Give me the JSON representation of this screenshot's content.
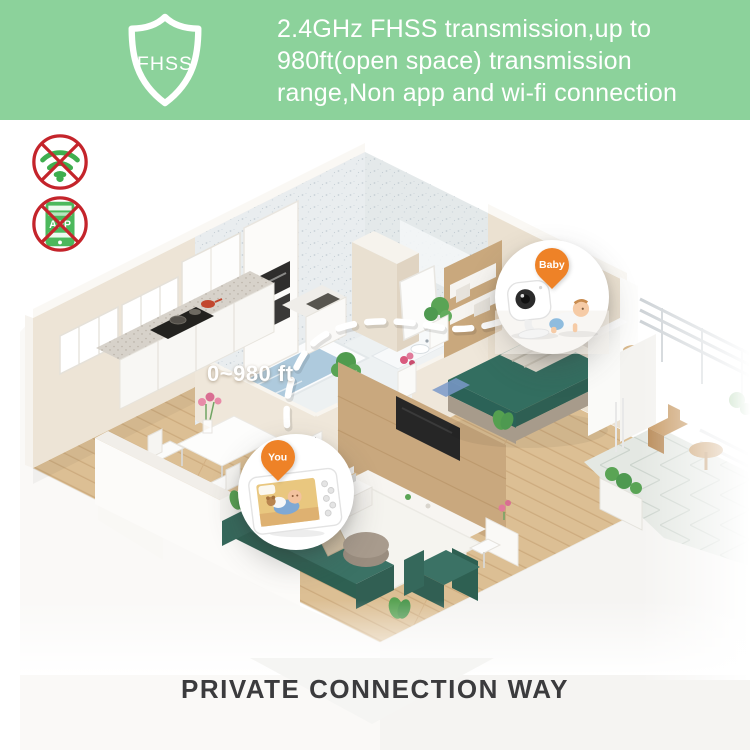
{
  "banner": {
    "shield_label": "FHSS",
    "line1": "2.4GHz FHSS transmission,up to",
    "line2": "980ft(open space) transmission",
    "line3": "range,Non app and wi-fi connection"
  },
  "badges": {
    "no_wifi_icon": "wifi-crossed-out",
    "no_app_icon": "phone-app-crossed-out",
    "app_label": "APP"
  },
  "labels": {
    "distance": "0~980 ft",
    "camera_bubble": "Baby",
    "monitor_bubble": "You"
  },
  "footer": {
    "caption": "PRIVATE CONNECTION WAY"
  },
  "icons": {
    "shield": "fhss-shield-icon",
    "pins": "location-pin-icon"
  },
  "colors": {
    "banner_green": "#8CD29B",
    "accent_orange": "#EE8227",
    "prohibition_red": "#C4242B",
    "icon_green": "#3FAE4F",
    "furniture_teal": "#336E60",
    "wood_floor": "#DCBF94"
  }
}
